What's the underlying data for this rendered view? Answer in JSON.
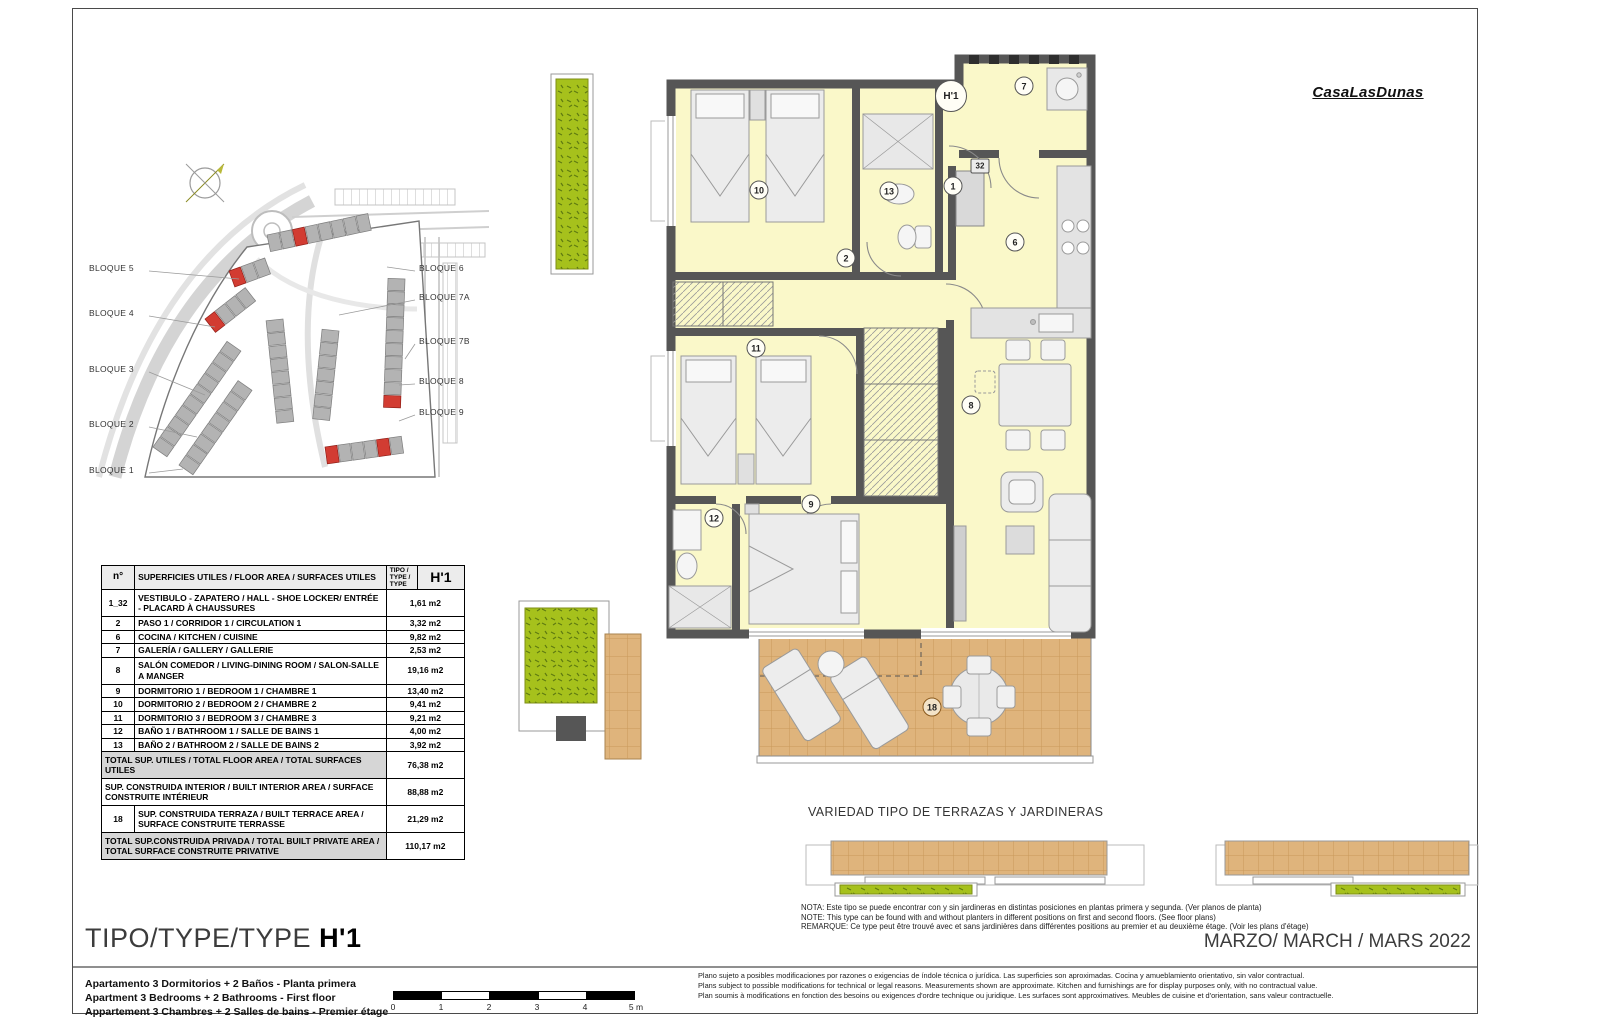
{
  "logo": "CasaLasDunas",
  "site_plan": {
    "left_labels": [
      "BLOQUE 5",
      "BLOQUE 4",
      "BLOQUE 3",
      "BLOQUE 2",
      "BLOQUE 1"
    ],
    "right_labels": [
      "BLOQUE 6",
      "BLOQUE 7A",
      "BLOQUE 7B",
      "BLOQUE 8",
      "BLOQUE 9"
    ]
  },
  "floor_plan": {
    "type_badge": "H'1",
    "rooms": [
      {
        "number": "10"
      },
      {
        "number": "13"
      },
      {
        "number": "7"
      },
      {
        "number": "1"
      },
      {
        "number": "32"
      },
      {
        "number": "2"
      },
      {
        "number": "6"
      },
      {
        "number": "11"
      },
      {
        "number": "8"
      },
      {
        "number": "9"
      },
      {
        "number": "12"
      },
      {
        "number": "18"
      }
    ]
  },
  "table": {
    "header": {
      "col_no": "n°",
      "col_desc": "SUPERFICIES UTILES / FLOOR AREA / SURFACES UTILES",
      "col_type": "TIPO / TYPE / TYPE",
      "col_value": "H'1"
    },
    "rows": [
      {
        "no": "1_32",
        "desc": "VESTIBULO - ZAPATERO / HALL - SHOE LOCKER/ ENTRÉE - PLACARD À CHAUSSURES",
        "value": "1,61 m2"
      },
      {
        "no": "2",
        "desc": "PASO 1 / CORRIDOR 1 / CIRCULATION 1",
        "value": "3,32 m2"
      },
      {
        "no": "6",
        "desc": "COCINA / KITCHEN / CUISINE",
        "value": "9,82 m2"
      },
      {
        "no": "7",
        "desc": "GALERÍA / GALLERY / GALLERIE",
        "value": "2,53 m2"
      },
      {
        "no": "8",
        "desc": "SALÓN COMEDOR  / LIVING-DINING ROOM / SALON-SALLE A MANGER",
        "value": "19,16 m2"
      },
      {
        "no": "9",
        "desc": "DORMITORIO 1 / BEDROOM 1 / CHAMBRE 1",
        "value": "13,40 m2"
      },
      {
        "no": "10",
        "desc": "DORMITORIO 2 / BEDROOM 2 / CHAMBRE 2",
        "value": "9,41 m2"
      },
      {
        "no": "11",
        "desc": "DORMITORIO 3 / BEDROOM 3 / CHAMBRE 3",
        "value": "9,21 m2"
      },
      {
        "no": "12",
        "desc": "BAÑO 1 / BATHROOM 1 / SALLE DE BAINS 1",
        "value": "4,00 m2"
      },
      {
        "no": "13",
        "desc": "BAÑO 2 / BATHROOM 2 / SALLE DE BAINS 2",
        "value": "3,92 m2"
      }
    ],
    "summary": [
      {
        "no": "",
        "desc": "TOTAL SUP. UTILES / TOTAL FLOOR AREA / TOTAL SURFACES UTILES",
        "value": "76,38 m2"
      },
      {
        "no": "",
        "desc": "SUP. CONSTRUIDA INTERIOR / BUILT INTERIOR AREA / SURFACE CONSTRUITE INTÉRIEUR",
        "value": "88,88 m2"
      },
      {
        "no": "18",
        "desc": "SUP. CONSTRUIDA TERRAZA / BUILT TERRACE AREA / SURFACE CONSTRUITE TERRASSE",
        "value": "21,29 m2"
      },
      {
        "no": "",
        "desc": "TOTAL SUP.CONSTRUIDA PRIVADA / TOTAL  BUILT PRIVATE AREA / TOTAL SURFACE CONSTRUITE PRIVATIVE",
        "value": "110,17 m2"
      }
    ]
  },
  "terraces": {
    "title": "VARIEDAD TIPO DE TERRAZAS Y JARDINERAS",
    "notes": [
      "NOTA: Este tipo se puede encontrar con y sin jardineras en distintas posiciones en plantas primera y segunda. (Ver planos de planta)",
      "NOTE: This type can be found with and without planters in different positions on first and second floors. (See floor plans)",
      "REMARQUE: Ce type peut être trouvé avec et sans jardinières dans différentes positions au premier et au deuxième étage. (Voir les plans d'étage)"
    ]
  },
  "title_block": {
    "type_label": "TIPO/TYPE/TYPE",
    "type_value": "H'1",
    "date": "MARZO/ MARCH / MARS  2022",
    "descriptions": [
      "Apartamento 3 Dormitorios + 2 Baños - Planta primera",
      "Apartment 3 Bedrooms + 2 Bathrooms - First floor",
      "Appartement 3 Chambres + 2 Salles de bains - Premier étage"
    ],
    "scale_ticks": [
      "0",
      "1",
      "2",
      "3",
      "4",
      "5 m"
    ],
    "disclaimers": [
      "Plano sujeto a posibles modificaciones por razones o exigencias de índole técnica o jurídica. Las superficies son aproximadas. Cocina y amueblamiento orientativo, sin valor contractual.",
      "Plans subject to possible modifications for technical or legal reasons. Measurements shown are approximate. Kitchen and furnishings are for display purposes only, with no contractual value.",
      "Plan soumis à modifications en fonction des besoins ou exigences d'ordre technique ou juridique. Les surfaces sont approximatives. Meubles de cuisine et d'orientation, sans valeur contractuelle."
    ]
  },
  "colors": {
    "wall": "#565656",
    "room_fill": "#faf8c9",
    "terrace": "#dfb47c",
    "planter_green": "#a6c11c",
    "highlight_red": "#d23c32",
    "table_shade": "#d6d6d6"
  }
}
